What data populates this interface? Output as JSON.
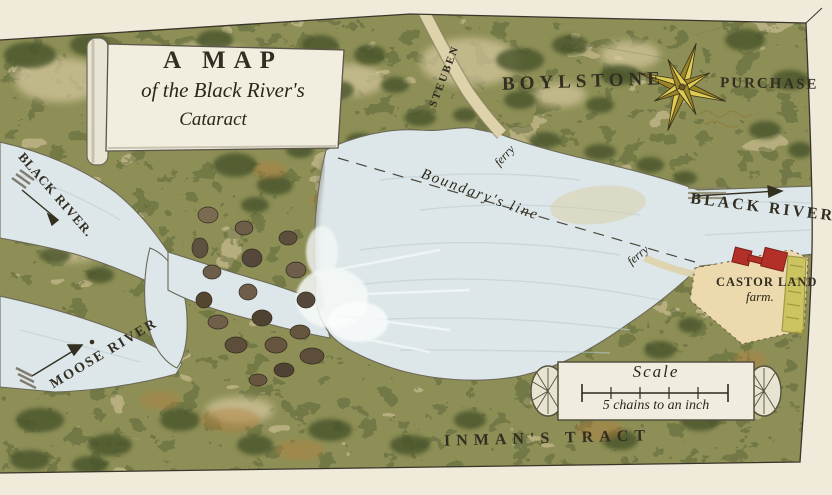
{
  "map": {
    "title": {
      "line1": "A MAP",
      "line2": "of the Black River's",
      "line3": "Cataract"
    },
    "labels": {
      "boylstone": "BOYLSTONE",
      "purchase": "PURCHASE",
      "steuben": "STEUBEN",
      "ferry_upper": "ferry",
      "ferry_lower": "ferry",
      "boundary_line": "Boundary's line",
      "black_river_left": "BLACK RIVER.",
      "black_river_right": "BLACK RIVER",
      "moose_river": "MOOSE RIVER",
      "castor_land": "CASTOR LAND",
      "castor_farm": "farm.",
      "inmans_tract": "INMAN'S TRACT"
    },
    "scale": {
      "title": "Scale",
      "caption": "5 chains to an inch"
    },
    "colors": {
      "paper": "#efead9",
      "terrain_green": "#8d8f56",
      "water": "#dde7ea",
      "compass_gold": "#e0cb55",
      "building_red": "#b23028",
      "ink": "#332e22"
    }
  }
}
